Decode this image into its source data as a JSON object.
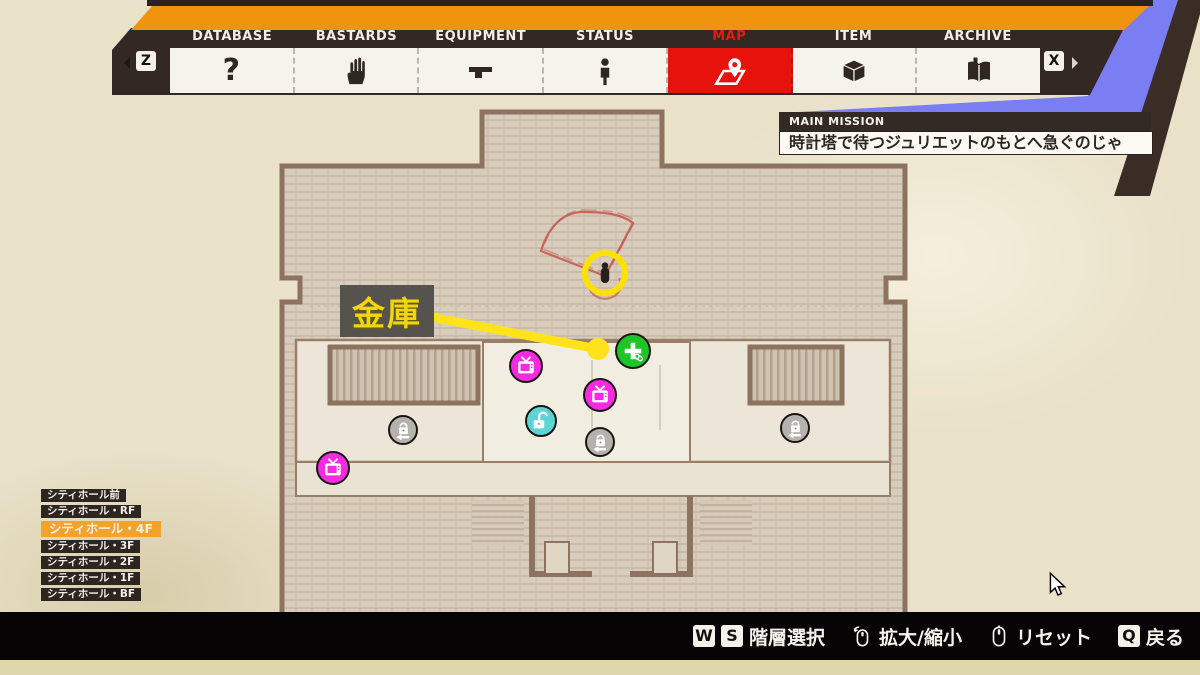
{
  "header": {
    "left_key": "Z",
    "right_key": "X",
    "tabs": [
      {
        "label": "DATABASE",
        "icon": "question-icon",
        "selected": false
      },
      {
        "label": "BASTARDS",
        "icon": "hand-icon",
        "selected": false
      },
      {
        "label": "EQUIPMENT",
        "icon": "pistol-icon",
        "selected": false
      },
      {
        "label": "STATUS",
        "icon": "person-icon",
        "selected": false
      },
      {
        "label": "MAP",
        "icon": "map-pin-icon",
        "selected": true
      },
      {
        "label": "ITEM",
        "icon": "box-icon",
        "selected": false
      },
      {
        "label": "ARCHIVE",
        "icon": "book-icon",
        "selected": false
      }
    ]
  },
  "mission": {
    "category": "MAIN MISSION",
    "text": "時計塔で待つジュリエットのもとへ急ぐのじゃ"
  },
  "map": {
    "callout": {
      "text": "金庫"
    },
    "markers": [
      {
        "type": "player",
        "name": "player-marker",
        "x": 605,
        "y": 273
      },
      {
        "type": "medkit",
        "name": "medkit-icon",
        "x": 633,
        "y": 351
      },
      {
        "type": "collectible",
        "name": "tv-collectible-icon",
        "x": 526,
        "y": 366
      },
      {
        "type": "collectible",
        "name": "tv-collectible-icon",
        "x": 600,
        "y": 395
      },
      {
        "type": "collectible",
        "name": "tv-collectible-icon",
        "x": 333,
        "y": 468
      },
      {
        "type": "unlocked-door",
        "name": "unlocked-door-icon",
        "x": 541,
        "y": 421
      },
      {
        "type": "locked-door",
        "name": "locked-door-icon",
        "x": 403,
        "y": 430
      },
      {
        "type": "locked-door",
        "name": "locked-door-icon",
        "x": 600,
        "y": 442
      },
      {
        "type": "locked-door",
        "name": "locked-door-icon",
        "x": 795,
        "y": 428
      }
    ]
  },
  "floor_list": {
    "items": [
      {
        "label": "シティホール前",
        "selected": false
      },
      {
        "label": "シティホール・RF",
        "selected": false
      },
      {
        "label": "シティホール・4F",
        "selected": true
      },
      {
        "label": "シティホール・3F",
        "selected": false
      },
      {
        "label": "シティホール・2F",
        "selected": false
      },
      {
        "label": "シティホール・1F",
        "selected": false
      },
      {
        "label": "シティホール・BF",
        "selected": false
      }
    ]
  },
  "controls": {
    "floor_select": {
      "keys": [
        "W",
        "S"
      ],
      "label": "階層選択"
    },
    "zoom": {
      "icon": "mouse-wheel-icon",
      "label": "拡大/縮小"
    },
    "reset": {
      "icon": "mouse-middle-icon",
      "label": "リセット"
    },
    "back": {
      "keys": [
        "Q"
      ],
      "label": "戻る"
    }
  },
  "colors": {
    "accent_orange": "#f0930e",
    "active_red": "#e8120c",
    "panel_blue": "#7b7df2",
    "floor_selected": "#f1a32b",
    "collectible_magenta": "#f42be0",
    "medkit_green": "#1ec529",
    "unlocked_cyan": "#5ed3d4",
    "marker_yellow": "#ffe31a"
  }
}
